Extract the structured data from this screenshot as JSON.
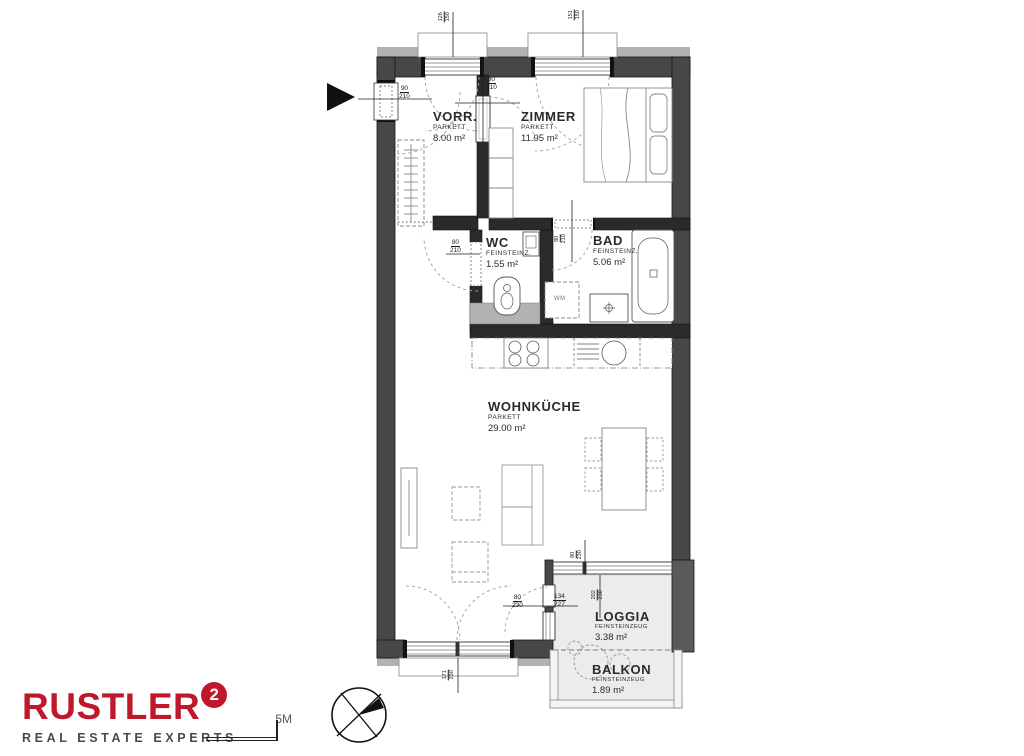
{
  "plan": {
    "rooms": [
      {
        "id": "vorraum",
        "name": "VORR.",
        "floor": "PARKETT",
        "area": "8.00 m²"
      },
      {
        "id": "zimmer",
        "name": "ZIMMER",
        "floor": "PARKETT",
        "area": "11.95 m²"
      },
      {
        "id": "wc",
        "name": "WC",
        "floor": "FEINSTEINZ.",
        "area": "1.55 m²"
      },
      {
        "id": "bad",
        "name": "BAD",
        "floor": "FEINSTEINZ.",
        "area": "5.06 m²"
      },
      {
        "id": "wohnkueche",
        "name": "WOHNKÜCHE",
        "floor": "PARKETT",
        "area": "29.00 m²"
      },
      {
        "id": "loggia",
        "name": "LOGGIA",
        "floor": "FEINSTEINZEUG",
        "area": "3.38 m²"
      },
      {
        "id": "balkon",
        "name": "BALKON",
        "floor": "FEINSTEINZEUG",
        "area": "1.89 m²"
      }
    ],
    "dimensions": {
      "entrance_door": {
        "w": "90",
        "h": "210"
      },
      "zimmer_door": {
        "w": "80",
        "h": "210"
      },
      "wc_door": {
        "w": "80",
        "h": "210"
      },
      "bad_door": {
        "w": "80",
        "h": "210"
      },
      "loggia_door": {
        "w": "80",
        "h": "230"
      },
      "loggia_window": {
        "w": "134",
        "h": "227"
      },
      "window_top_left": {
        "w": "126",
        "h": "150"
      },
      "window_top_right": {
        "w": "151",
        "h": "150"
      },
      "window_bottom": {
        "w": "171",
        "h": "230"
      },
      "loggia_glazing_a": {
        "w": "80",
        "h": "230"
      },
      "loggia_glazing_b": {
        "w": "202",
        "h": "230"
      }
    },
    "fixtures": {
      "washing_machine": "WM"
    }
  },
  "footer": {
    "brand": {
      "name": "RUSTLER",
      "superscript": "2",
      "tagline": "REAL ESTATE EXPERTS",
      "brand_color": "#c0182b"
    },
    "scale": {
      "label": "5M"
    }
  }
}
